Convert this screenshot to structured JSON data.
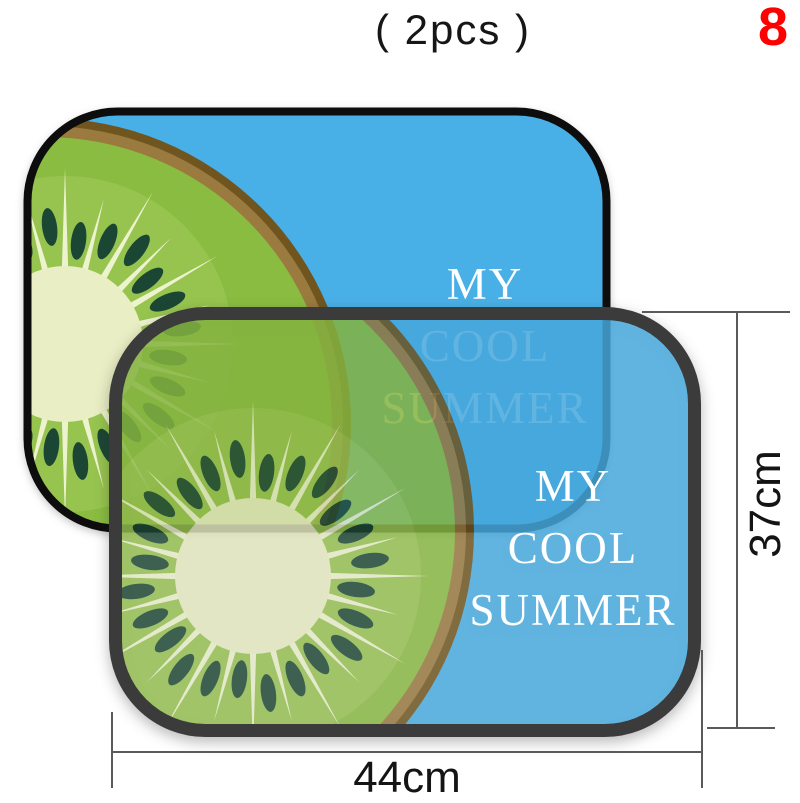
{
  "header": {
    "quantity_label": "( 2pcs )",
    "page_number": "8"
  },
  "sunshade": {
    "caption_line1": "MY",
    "caption_line2": "COOL",
    "caption_line3": "SUMMER"
  },
  "dimensions": {
    "width_label": "44cm",
    "height_label": "37cm"
  },
  "colors": {
    "shade_blue": "#49b0e7",
    "kiwi_flesh": "#8abc41",
    "kiwi_flesh_light": "#a3cc5e",
    "kiwi_core": "#e9eec4",
    "kiwi_skin": "#9a7a3e",
    "kiwi_skin_dark": "#70551f",
    "kiwi_seed": "#1c4634",
    "kiwi_ray": "#eef3cf",
    "shade_text": "#ffffff",
    "border_back": "#0d0d0d",
    "border_front": "#3b3b3b",
    "dimension_line": "#5a5a5a",
    "dimension_text": "#141414",
    "page_number_red": "#fe0000"
  }
}
